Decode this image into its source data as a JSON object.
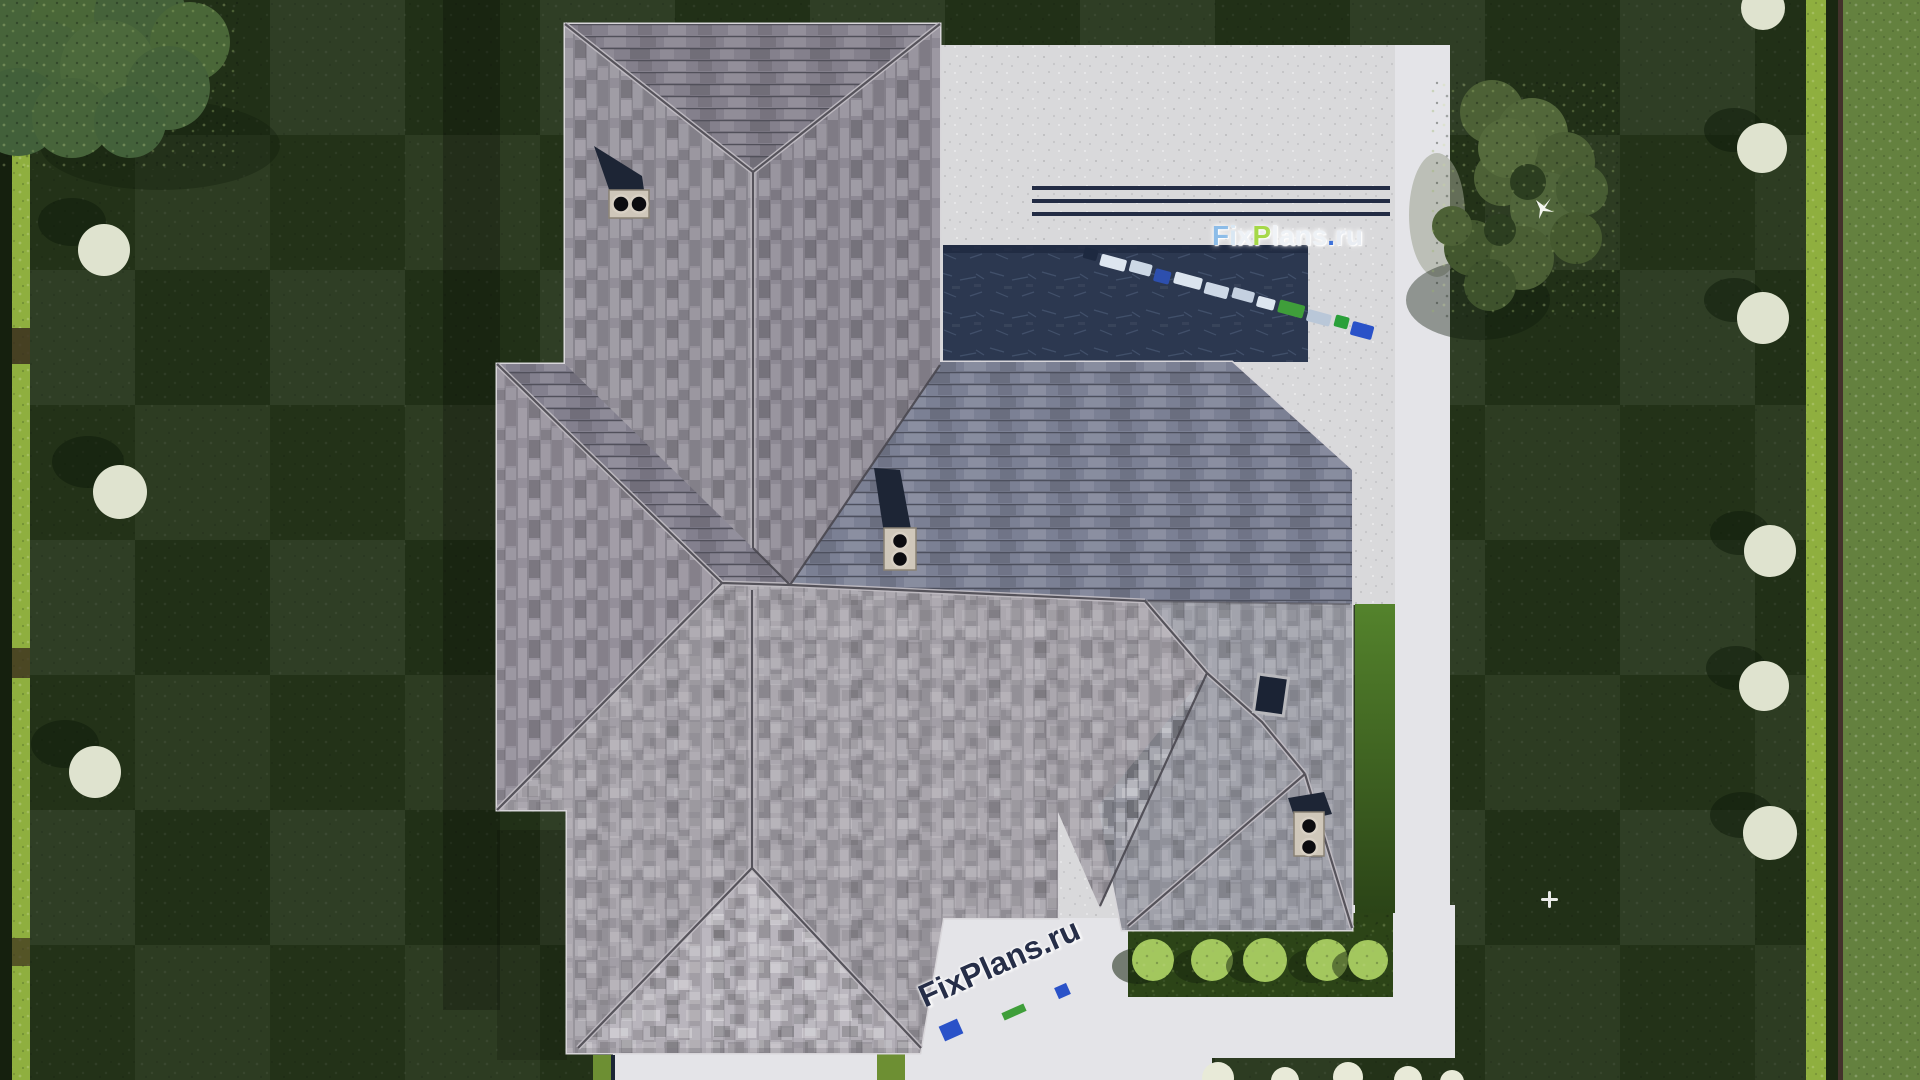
{
  "watermarks": {
    "main": {
      "text": "FixPlans.ru",
      "letters": [
        {
          "ch": "F",
          "color": "#8cbce8"
        },
        {
          "ch": "i",
          "color": "#d9e7f3"
        },
        {
          "ch": "x",
          "color": "#eef2f7"
        },
        {
          "ch": "P",
          "color": "#a5d848"
        },
        {
          "ch": "l",
          "color": "#f0f3f7"
        },
        {
          "ch": "a",
          "color": "#eef2f6"
        },
        {
          "ch": "n",
          "color": "#edf1f6"
        },
        {
          "ch": "s",
          "color": "#eef2f6"
        },
        {
          "ch": ".",
          "color": "#3a6fd8"
        },
        {
          "ch": "r",
          "color": "#e9edf3"
        },
        {
          "ch": "u",
          "color": "#e9edf3"
        }
      ]
    },
    "driveway": {
      "text": "FixPlans.ru",
      "color": "#262e48"
    }
  },
  "colors": {
    "lawn": "#243419",
    "lawn_shadow": "#101c0c",
    "outer_lawn": "#64813f",
    "hedge": "#8faf3f",
    "hedge_dark_strip": "#15200e",
    "fence": "#43322b",
    "patio_concrete": "#d9d9db",
    "walkway": "#e4e4e8",
    "pool_water": "#2c3850",
    "pool_step_line": "#232c44",
    "roof_base": "#9b97a0",
    "roof_dark_slope": "#7b8094",
    "roof_light_slope": "#aeaab2",
    "roof_line": "#4a4850",
    "ridge_cap": "#c2bec4",
    "fascia": "#d8d6da",
    "chimney_shadow": "#1d2535",
    "chimney_cap": "#cfc7ba",
    "flue": "#0c0c10",
    "skylight": "#1b2334",
    "bed_soil": "#2c4417",
    "shrub_bright": "#a3c75e",
    "shrub_white": "#dfe3cf",
    "tree_canopy": "#4d6136",
    "tree_canopy_light": "#47643a",
    "float_green": "#3f9e3a",
    "float_blue": "#2a52c8"
  },
  "pool": {
    "floats": [
      {
        "w": 14,
        "h": 11,
        "c": "#1d2940"
      },
      {
        "w": 26,
        "h": 12,
        "c": "#dde6f0"
      },
      {
        "w": 22,
        "h": 12,
        "c": "#ccd8e6"
      },
      {
        "w": 16,
        "h": 13,
        "c": "#2d4fae"
      },
      {
        "w": 28,
        "h": 12,
        "c": "#dbe4ee"
      },
      {
        "w": 24,
        "h": 12,
        "c": "#cdd8e6"
      },
      {
        "w": 22,
        "h": 11,
        "c": "#c4d0e0"
      },
      {
        "w": 18,
        "h": 11,
        "c": "#dde6f0"
      },
      {
        "w": 26,
        "h": 13,
        "c": "#3f9e3a"
      },
      {
        "w": 24,
        "h": 12,
        "c": "#b9c7d8"
      },
      {
        "w": 14,
        "h": 12,
        "c": "#2aa03a"
      },
      {
        "w": 22,
        "h": 14,
        "c": "#2a52c8"
      }
    ]
  }
}
